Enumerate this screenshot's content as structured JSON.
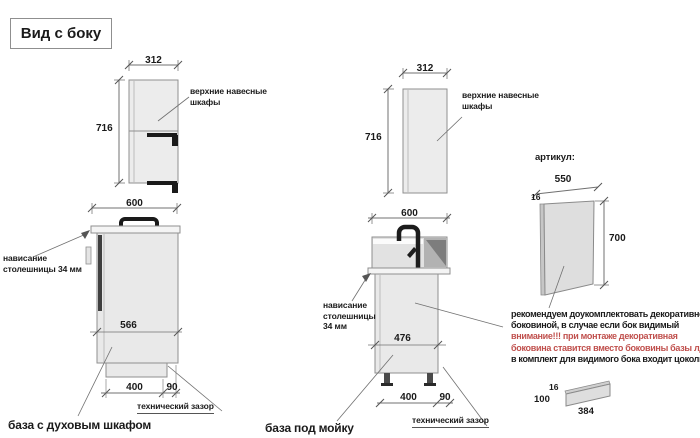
{
  "title": "Вид с боку",
  "colors": {
    "red_warning": "#c0504d",
    "cabinet_fill": "#ececec",
    "outline": "#8f8f8f"
  },
  "left_unit": {
    "upper_cabinet_label_lines": [
      "верхние навесные",
      "шкафы"
    ],
    "dim_upper_width": "312",
    "dim_upper_height": "716",
    "dim_base_width": "600",
    "dim_base_inner": "566",
    "dim_plinth": "400",
    "dim_gap": "90",
    "overhang_lines": [
      "нависание",
      "столешницы 34 мм"
    ],
    "tech_gap_label": "технический зазор",
    "name": "база с духовым шкафом"
  },
  "middle_unit": {
    "upper_cabinet_label_lines": [
      "верхние навесные",
      "шкафы"
    ],
    "dim_upper_width": "312",
    "dim_upper_height": "716",
    "dim_base_width": "600",
    "dim_base_inner": "476",
    "dim_plinth": "400",
    "dim_gap": "90",
    "overhang_lines": [
      "нависание",
      "столешницы",
      "34 мм"
    ],
    "tech_gap_label": "технический зазор",
    "name": "база под мойку"
  },
  "right_panel": {
    "articul_label": "артикул:",
    "dim_width": "550",
    "dim_thickness": "16",
    "dim_height": "700",
    "note_lines": [
      {
        "text": "рекомендуем доукомплектовать декоративной",
        "red": false
      },
      {
        "text": "боковиной, в случае если бок видимый",
        "red": false
      },
      {
        "text": "внимание!!! при монтаже декоративная",
        "red": true
      },
      {
        "text": "боковина ставится вместо боковины базы лдсп",
        "red": true
      },
      {
        "text": "в комплект для видимого бока входит цоколь:",
        "red": false
      }
    ],
    "plinth": {
      "dim_thickness": "16",
      "dim_height": "100",
      "dim_width": "384"
    }
  }
}
